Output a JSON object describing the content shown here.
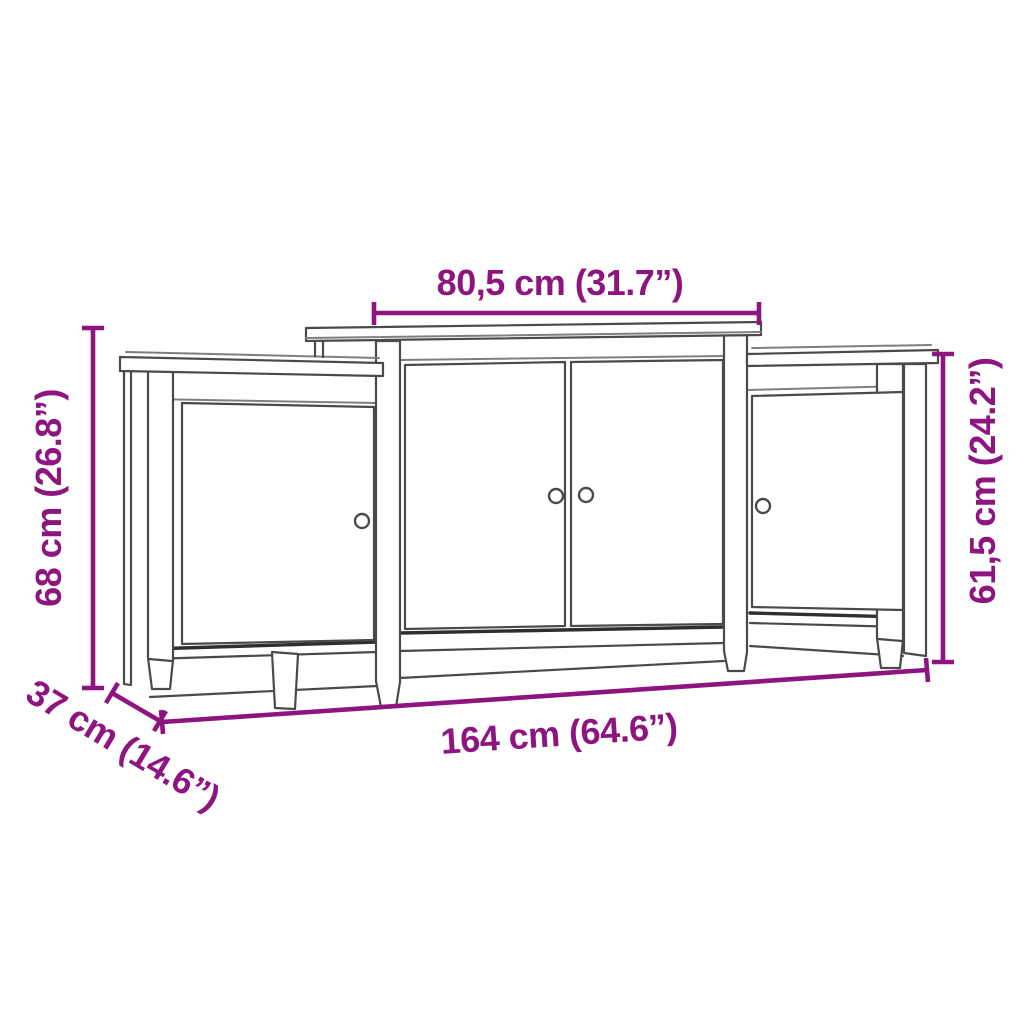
{
  "title": "Sideboard dimension diagram",
  "colors": {
    "accent": "#8e157f",
    "line": "#4a4a4a",
    "background": "#ffffff"
  },
  "furniture": {
    "description": "three-section sideboard with raised centre top, two centre doors and one door on each side section, four round knobs, square legs",
    "sections": [
      "left cabinet",
      "centre cabinet",
      "right cabinet"
    ],
    "door_count": 4,
    "knob_count": 4
  },
  "dimensions": {
    "top_width": "80,5 cm (31.7”)",
    "left_height": "68 cm (26.8”)",
    "right_height": "61,5 cm (24.2”)",
    "total_width": "164 cm (64.6”)",
    "depth": "37 cm (14.6”)"
  }
}
